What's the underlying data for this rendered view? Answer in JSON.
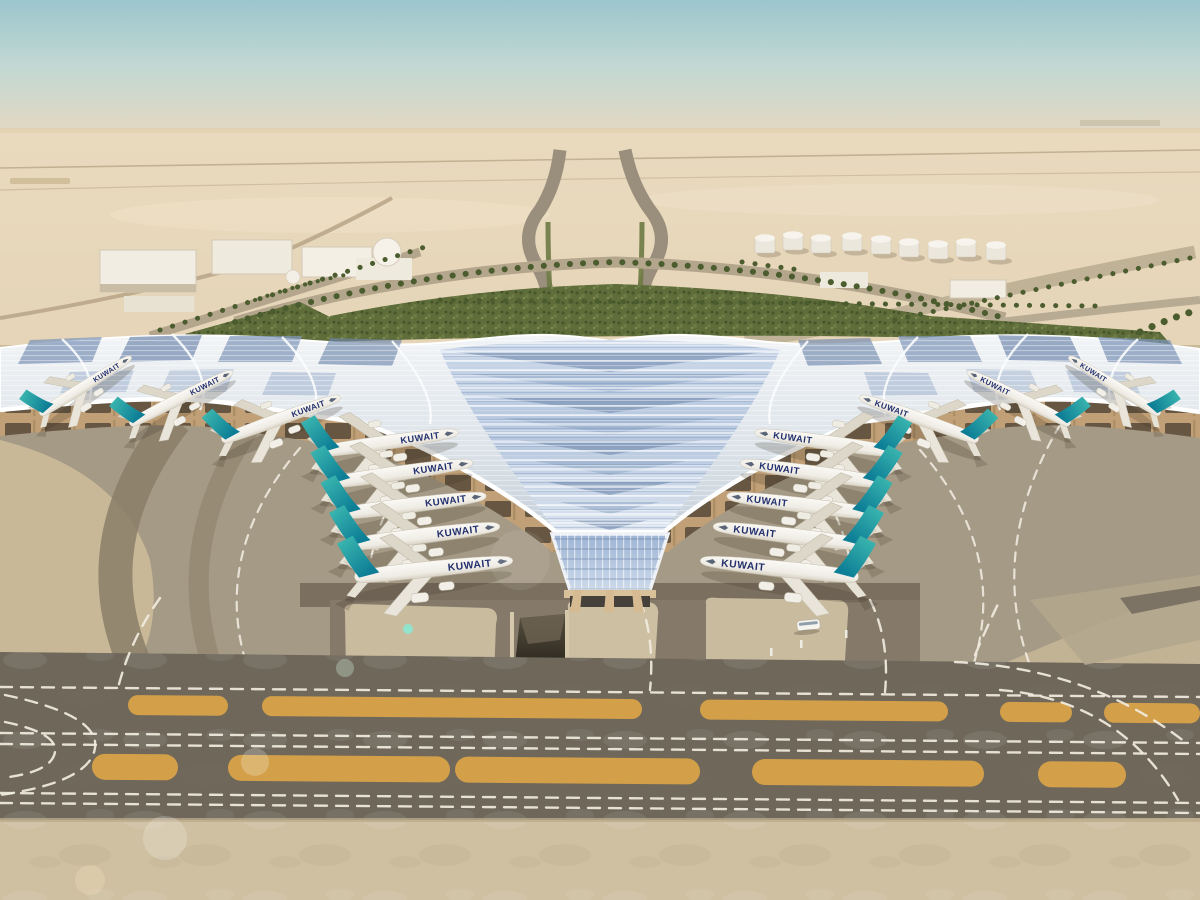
{
  "image": {
    "kind": "aerial-architectural-rendering",
    "subject": "Kuwait International Airport trefoil-roof terminal in desert setting"
  },
  "colors": {
    "sky_top": "#9cc6cd",
    "sky_mid": "#c2d8d3",
    "sky_horizon": "#e7d9c2",
    "desert_far": "#e9dabf",
    "desert_near": "#dcc9a8",
    "vegetation": "#5e6d3a",
    "roof_white": "#f2f4f6",
    "roof_silver": "#c6d0da",
    "roof_blue_light": "#a9bcd6",
    "roof_blue_dark": "#7089ae",
    "underside_tan": "#c2a077",
    "gate_shadow": "#564939",
    "glass_blue": "#9db4d4",
    "apron_gray": "#a59a85",
    "apron_light": "#c9bb9e",
    "band_dark": "#8a7e68",
    "taxiway_dark": "#6f675a",
    "bottom_concrete": "#cfc0a1",
    "marking_orange": "#d8a349",
    "marking_white": "#f1ece0",
    "tail_teal_top": "#3fbcb2",
    "tail_teal_bottom": "#0d7e96",
    "fuselage": "#f4f2ee",
    "title_navy": "#22306e"
  },
  "aircraft": {
    "title": "KUWAIT",
    "left": [
      {
        "x": 40,
        "y": 414,
        "r": -32,
        "s": 0.7
      },
      {
        "x": 130,
        "y": 424,
        "r": -27,
        "s": 0.75
      },
      {
        "x": 222,
        "y": 440,
        "r": -20,
        "s": 0.82
      },
      {
        "x": 318,
        "y": 452,
        "r": -8,
        "s": 0.92
      },
      {
        "x": 328,
        "y": 483,
        "r": -8,
        "s": 0.95
      },
      {
        "x": 338,
        "y": 514,
        "r": -7,
        "s": 0.97
      },
      {
        "x": 347,
        "y": 545,
        "r": -7,
        "s": 1.0
      },
      {
        "x": 355,
        "y": 577,
        "r": -6,
        "s": 1.03
      }
    ],
    "right": [
      {
        "x": 1160,
        "y": 414,
        "r": 32,
        "s": 0.7
      },
      {
        "x": 1070,
        "y": 424,
        "r": 27,
        "s": 0.75
      },
      {
        "x": 978,
        "y": 440,
        "r": 20,
        "s": 0.82
      },
      {
        "x": 895,
        "y": 452,
        "r": 8,
        "s": 0.92
      },
      {
        "x": 885,
        "y": 483,
        "r": 8,
        "s": 0.95
      },
      {
        "x": 875,
        "y": 514,
        "r": 7,
        "s": 0.97
      },
      {
        "x": 866,
        "y": 545,
        "r": 7,
        "s": 1.0
      },
      {
        "x": 858,
        "y": 577,
        "r": 6,
        "s": 1.03
      }
    ]
  },
  "fuel_tanks": [
    {
      "x": 765,
      "y": 250
    },
    {
      "x": 793,
      "y": 247
    },
    {
      "x": 821,
      "y": 250
    },
    {
      "x": 852,
      "y": 248
    },
    {
      "x": 881,
      "y": 251
    },
    {
      "x": 909,
      "y": 254
    },
    {
      "x": 938,
      "y": 256
    },
    {
      "x": 966,
      "y": 254
    },
    {
      "x": 996,
      "y": 257
    }
  ],
  "palm_rows": [
    {
      "d": "M235,322 Q420,268 615,262 Q810,268 1005,318",
      "w": 6
    },
    {
      "d": "M440,300 L1100,306",
      "w": 5
    },
    {
      "d": "M160,330 L425,247",
      "w": 5
    },
    {
      "d": "M1190,258 Q1030,290 885,322",
      "w": 5
    },
    {
      "d": "M742,262 L800,270",
      "w": 5
    },
    {
      "d": "M1140,332 Q1170,318 1198,310",
      "w": 7
    },
    {
      "d": "M255,300 Q300,284 350,274",
      "w": 4
    }
  ],
  "ground_markings": {
    "orange_rows": [
      {
        "y": 694,
        "h": 20,
        "segments": [
          {
            "x": 128,
            "w": 100
          },
          {
            "x": 262,
            "w": 380
          },
          {
            "x": 700,
            "w": 248
          },
          {
            "x": 1000,
            "w": 72
          },
          {
            "x": 1104,
            "w": 96
          }
        ]
      },
      {
        "y": 753,
        "h": 26,
        "segments": [
          {
            "x": 92,
            "w": 86
          },
          {
            "x": 228,
            "w": 222
          },
          {
            "x": 455,
            "w": 245
          },
          {
            "x": 752,
            "w": 232
          },
          {
            "x": 1038,
            "w": 88
          }
        ]
      }
    ],
    "dashed_paths": [
      "M0,687 L1200,697",
      "M0,733 L1200,743",
      "M0,744 L1200,754",
      "M0,793 L1200,803",
      "M0,803 L1200,813",
      "M5,695 Q100,715 95,748 Q90,782 0,795",
      "M5,722 Q58,733 55,752 Q52,772 2,778",
      "M955,662 Q1090,668 1185,742",
      "M1000,690 Q1120,700 1178,800",
      "M640,600 Q655,640 650,690",
      "M870,600 Q890,640 885,692",
      "M160,598 Q130,640 118,688",
      "M975,655 Q990,620 1000,600"
    ],
    "apron_guidelines": [
      "M430,445 Q330,560 390,692",
      "M300,448 Q200,565 258,695",
      "M790,445 Q890,560 832,692",
      "M920,450 Q1020,565 962,695",
      "M1060,425 Q980,560 1040,690"
    ]
  },
  "lens_flares": [
    {
      "x": 408,
      "y": 629,
      "r": 5,
      "c": "#8be8cf",
      "o": 0.9
    },
    {
      "x": 345,
      "y": 668,
      "r": 9,
      "c": "#cfe8d8",
      "o": 0.35
    },
    {
      "x": 255,
      "y": 762,
      "r": 14,
      "c": "#ffffff",
      "o": 0.22
    },
    {
      "x": 165,
      "y": 838,
      "r": 22,
      "c": "#ffffff",
      "o": 0.2
    },
    {
      "x": 90,
      "y": 880,
      "r": 15,
      "c": "#ffe9c9",
      "o": 0.25
    },
    {
      "x": 520,
      "y": 560,
      "r": 30,
      "c": "#ffffff",
      "o": 0.08
    }
  ]
}
